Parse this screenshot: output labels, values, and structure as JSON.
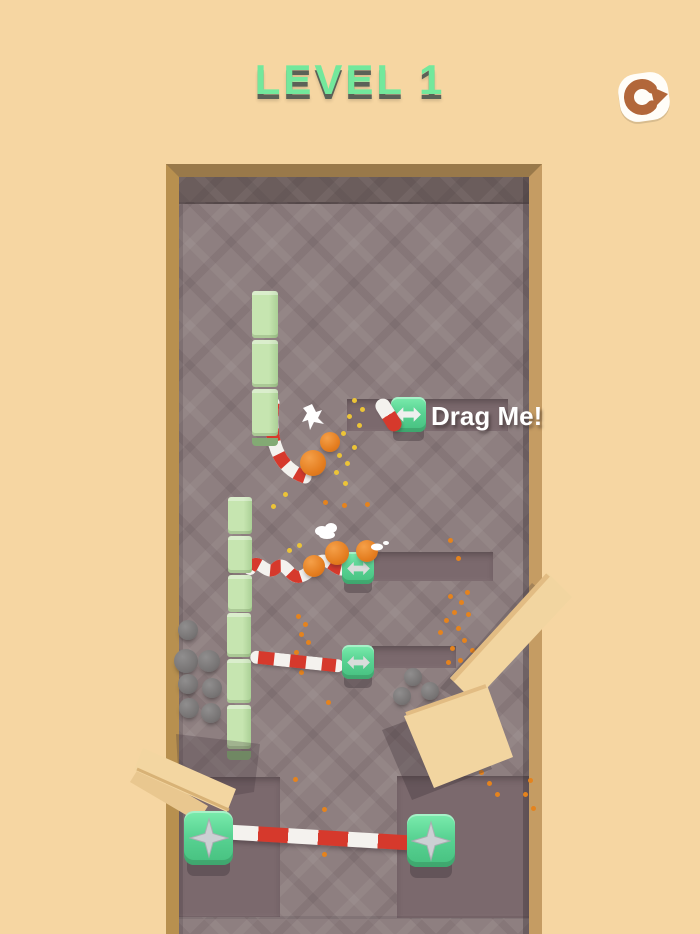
{
  "header": {
    "level_title": "LEVEL 1"
  },
  "labels": {
    "drag_me": "Drag Me!"
  },
  "icons": {
    "restart": "restart-circular-arrow",
    "cube_arrow": "double-horizontal-arrow",
    "cube_star": "four-way-arrow-star"
  },
  "colors": {
    "background": "#f6d6a2",
    "floor": "#8e7f80",
    "floor_pit": "#7b696d",
    "wall_top": "#6b5d5c",
    "frame_top": "#99794a",
    "frame_left": "#b8904f",
    "frame_right": "#c59c63",
    "title_green": "#73e89c",
    "title_shadow": "#5b6157",
    "cube_green": "#55cb8c",
    "stripe_red": "#d6392c",
    "stripe_white": "#f4f2ee",
    "block_green": "#b9dda4",
    "ball_orange": "#e8832c",
    "boulder_gray": "#7d7a7a",
    "wood_tan": "#f2d5a0",
    "restart_brown": "#b2673a",
    "sand_orange": "#e5831d",
    "sand_yellow": "#ecc437"
  },
  "stacks": [
    {
      "x": 252,
      "y": 291,
      "w": 26,
      "segH": 47,
      "count": 3,
      "foot": 8
    },
    {
      "x": 228,
      "y": 497,
      "w": 24,
      "segH": 37,
      "count": 3,
      "foot": 0
    },
    {
      "x": 227,
      "y": 613,
      "w": 24,
      "segH": 44,
      "count": 3,
      "foot": 9
    }
  ],
  "balls": [
    [
      330,
      442,
      10
    ],
    [
      313,
      463,
      13
    ],
    [
      314,
      566,
      11
    ],
    [
      337,
      553,
      12
    ],
    [
      367,
      551,
      11
    ]
  ],
  "boulders": [
    [
      188,
      630,
      10
    ],
    [
      186,
      661,
      12
    ],
    [
      209,
      661,
      11
    ],
    [
      188,
      684,
      10
    ],
    [
      212,
      688,
      10
    ],
    [
      189,
      708,
      10
    ],
    [
      211,
      713,
      10
    ],
    [
      413,
      677,
      9
    ],
    [
      402,
      696,
      9
    ],
    [
      430,
      691,
      9
    ]
  ],
  "particles": [
    [
      352,
      398,
      "y"
    ],
    [
      360,
      407,
      "y"
    ],
    [
      347,
      414,
      "y"
    ],
    [
      357,
      423,
      "y"
    ],
    [
      341,
      431,
      "y"
    ],
    [
      352,
      445,
      "y"
    ],
    [
      337,
      453,
      "y"
    ],
    [
      345,
      461,
      "y"
    ],
    [
      334,
      470,
      "y"
    ],
    [
      343,
      481,
      "y"
    ],
    [
      301,
      474,
      "y"
    ],
    [
      283,
      492,
      "y"
    ],
    [
      271,
      504,
      "y"
    ],
    [
      323,
      500,
      "o"
    ],
    [
      342,
      503,
      "o"
    ],
    [
      365,
      502,
      "o"
    ],
    [
      287,
      548,
      "y"
    ],
    [
      297,
      543,
      "y"
    ],
    [
      448,
      538,
      "o"
    ],
    [
      456,
      556,
      "o"
    ],
    [
      296,
      614,
      "o"
    ],
    [
      303,
      622,
      "o"
    ],
    [
      299,
      632,
      "o"
    ],
    [
      306,
      640,
      "o"
    ],
    [
      294,
      650,
      "o"
    ],
    [
      304,
      658,
      "o"
    ],
    [
      299,
      670,
      "o"
    ],
    [
      326,
      700,
      "o"
    ],
    [
      465,
      590,
      "o"
    ],
    [
      448,
      594,
      "o"
    ],
    [
      459,
      600,
      "o"
    ],
    [
      452,
      610,
      "o"
    ],
    [
      444,
      618,
      "o"
    ],
    [
      466,
      612,
      "o"
    ],
    [
      456,
      626,
      "o"
    ],
    [
      438,
      630,
      "o"
    ],
    [
      462,
      638,
      "o"
    ],
    [
      450,
      646,
      "o"
    ],
    [
      470,
      648,
      "o"
    ],
    [
      458,
      658,
      "o"
    ],
    [
      446,
      660,
      "o"
    ],
    [
      472,
      664,
      "o"
    ],
    [
      293,
      777,
      "o"
    ],
    [
      322,
      807,
      "o"
    ],
    [
      322,
      852,
      "o"
    ],
    [
      470,
      757,
      "o"
    ],
    [
      479,
      770,
      "o"
    ],
    [
      487,
      781,
      "o"
    ],
    [
      495,
      792,
      "o"
    ],
    [
      528,
      778,
      "o"
    ],
    [
      523,
      792,
      "o"
    ],
    [
      531,
      806,
      "o"
    ]
  ]
}
